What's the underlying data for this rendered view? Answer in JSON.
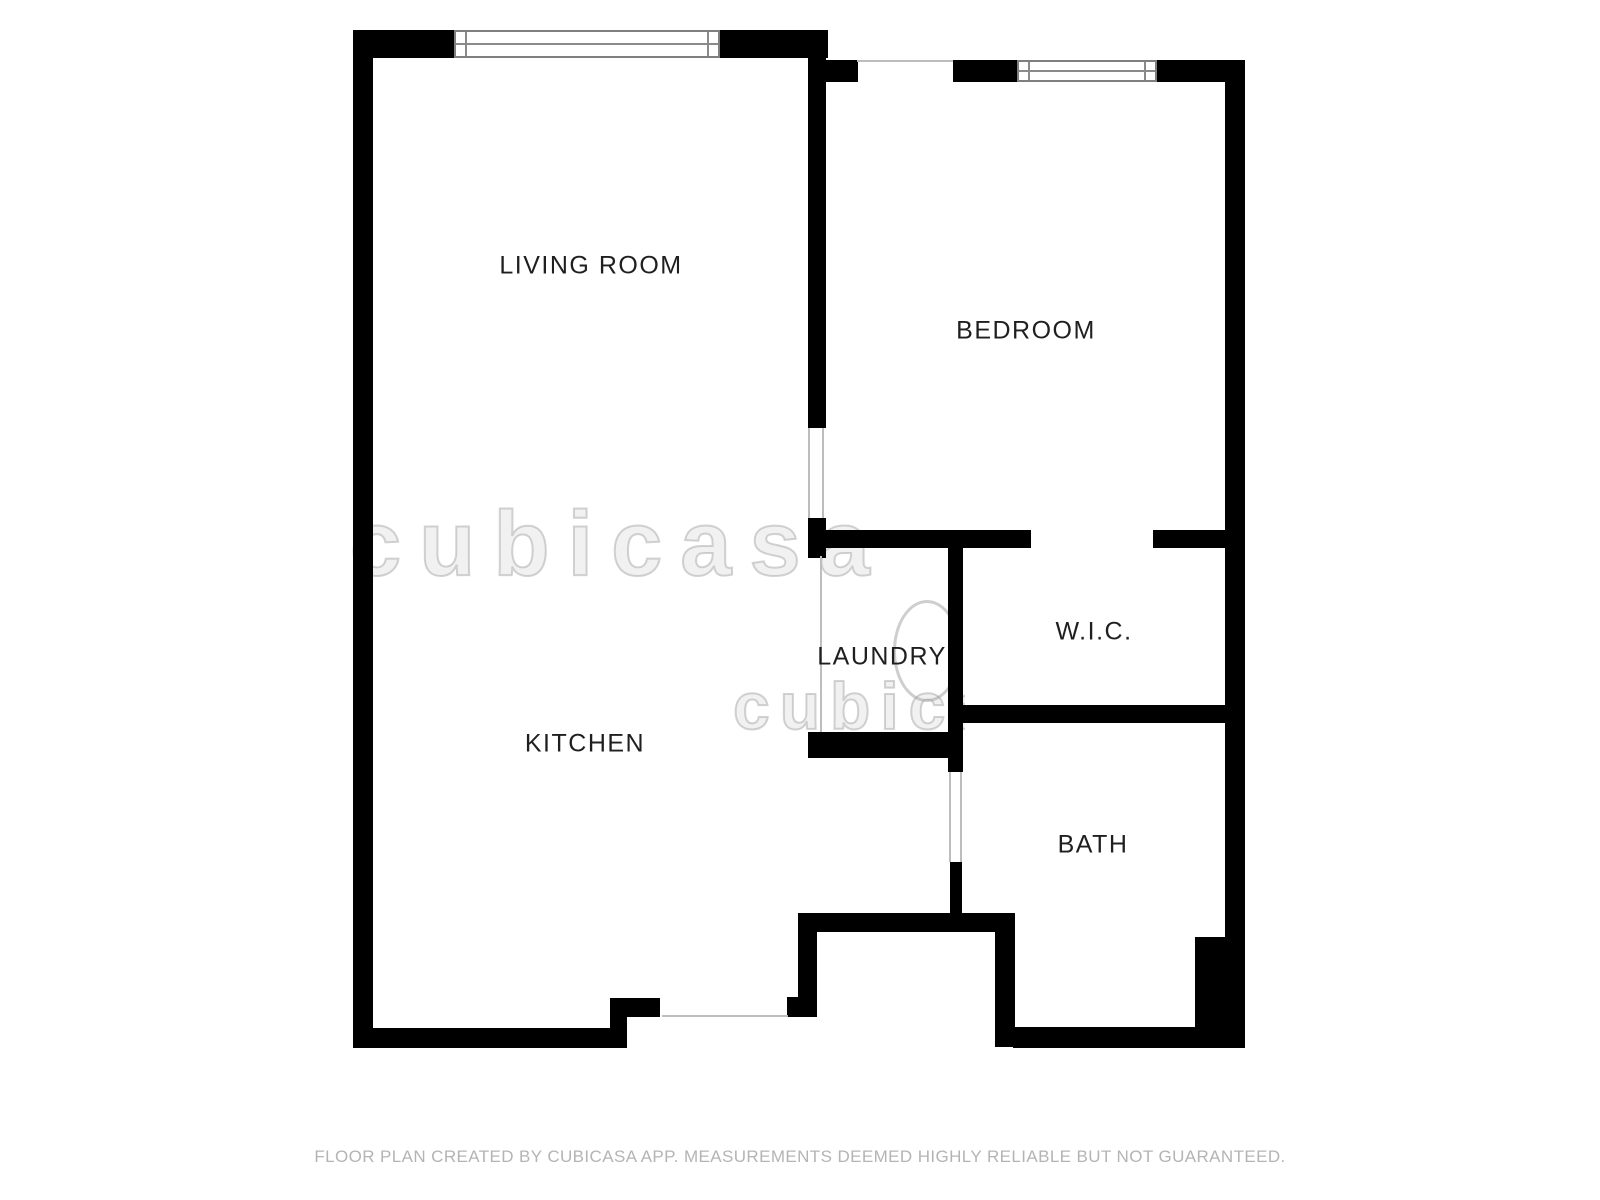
{
  "plan": {
    "type": "floor-plan",
    "wall_color": "#000000",
    "label_color": "#1f1f1f",
    "rooms": [
      {
        "label": "LIVING ROOM"
      },
      {
        "label": "BEDROOM"
      },
      {
        "label": "KITCHEN"
      },
      {
        "label": "LAUNDRY"
      },
      {
        "label": "W.I.C."
      },
      {
        "label": "BATH"
      }
    ],
    "features": {
      "windows": [
        "living-room-window",
        "bedroom-window"
      ],
      "openings": [
        "living-to-bedroom-doorway",
        "wic-doorway",
        "bath-doorway",
        "laundry-open-side",
        "entry-opening",
        "bedroom-top-opening"
      ]
    },
    "watermark_text": "cubicasa"
  },
  "footer": {
    "disclaimer": "FLOOR PLAN CREATED BY CUBICASA APP. MEASUREMENTS DEEMED HIGHLY RELIABLE BUT NOT GUARANTEED."
  }
}
